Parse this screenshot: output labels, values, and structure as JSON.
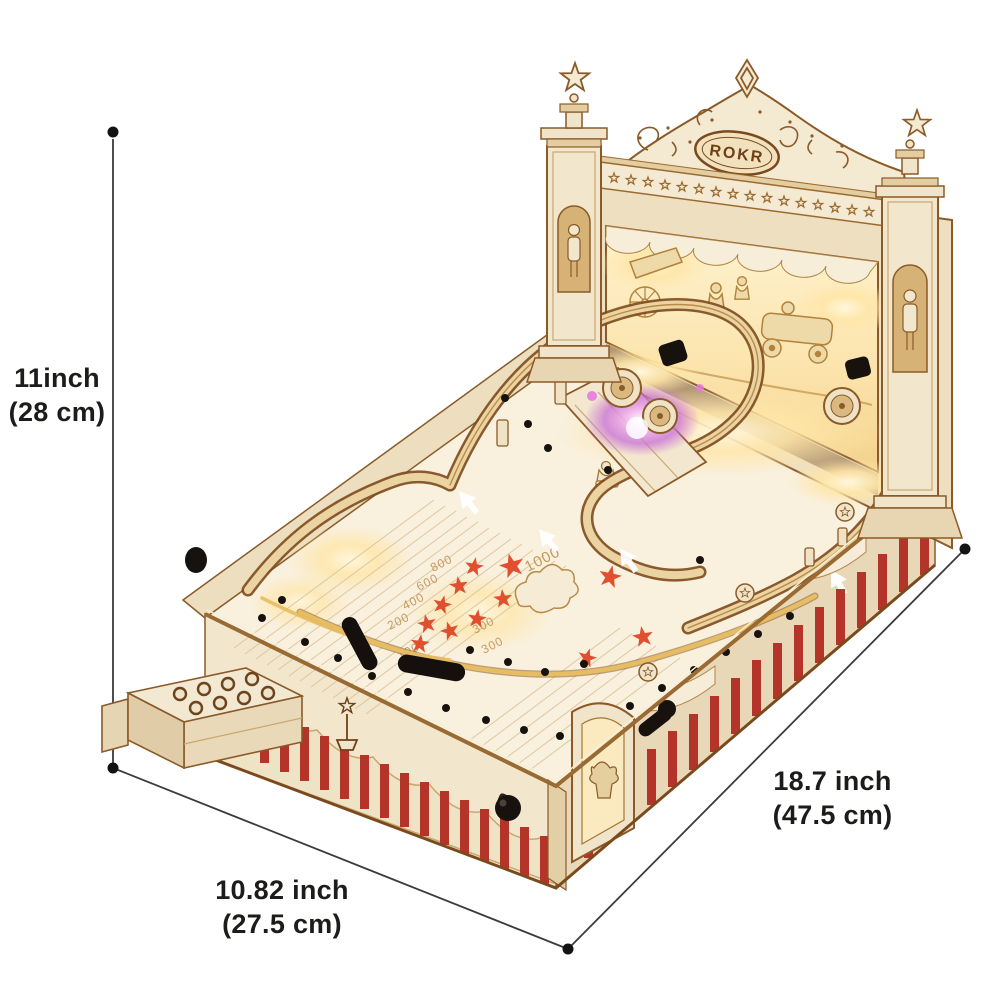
{
  "brand": {
    "logo_text": "ROKR"
  },
  "dimension_labels": {
    "height": {
      "imperial": "11inch",
      "metric": "(28 cm)"
    },
    "width": {
      "imperial": "10.82 inch",
      "metric": "(27.5 cm)"
    },
    "length": {
      "imperial": "18.7 inch",
      "metric": "(47.5 cm)"
    }
  },
  "playfield_scores": {
    "s1000": "1000",
    "s800": "800",
    "s600": "600",
    "s400": "400",
    "s200": "200",
    "s100": "100",
    "s300a": "300",
    "s300b": "300"
  },
  "colors": {
    "background": "#ffffff",
    "wood_light": "#f4e9d3",
    "wood_mid": "#dcbd8e",
    "wood_outline": "#8a5a28",
    "glow_warm": "#ffe6a8",
    "glow_purple": "#c96fd6",
    "stripe_red": "#b5342a",
    "star_red": "#e1502e",
    "hardware_black": "#17120e",
    "dimension_line": "#3b3b3b",
    "label_text": "#1d1c1a"
  }
}
